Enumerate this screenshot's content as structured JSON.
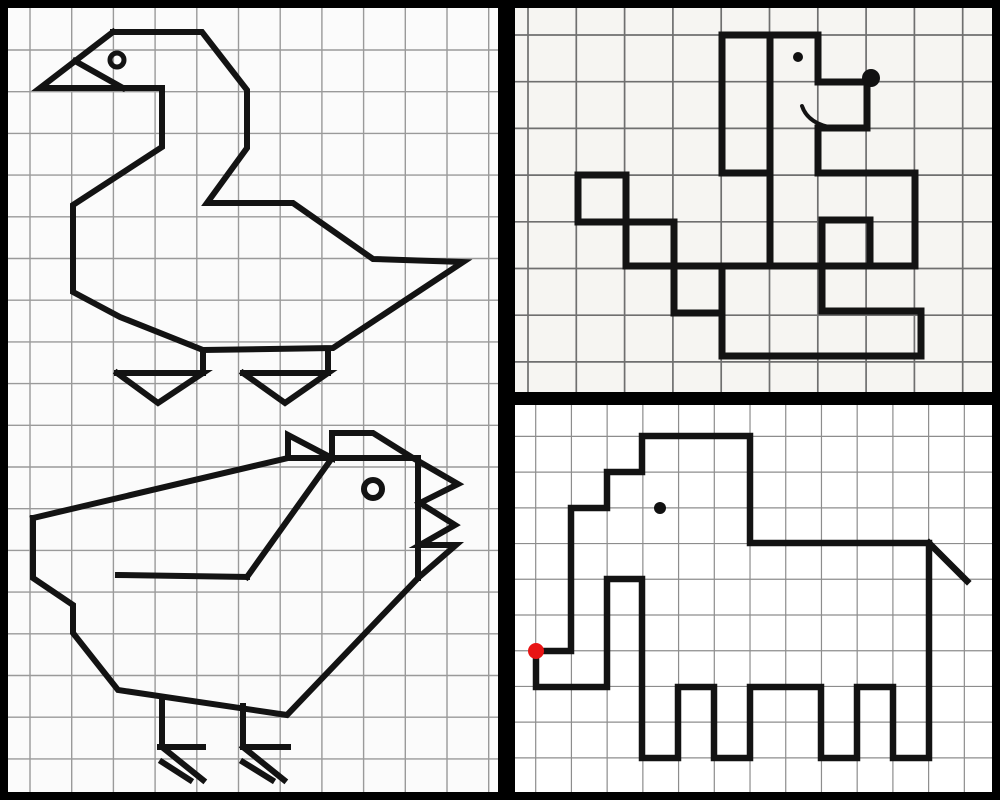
{
  "app": {
    "description": "Grid-drawing worksheet collage: goose and chicken on left, dog top-right, elephant bottom-right, drawn on squared paper inside a black frame"
  },
  "canvas": {
    "width": 1000,
    "height": 800,
    "frame_color": "#000000"
  },
  "panels": [
    {
      "name": "goose-chicken-panel",
      "x": 8,
      "y": 8,
      "width": 490,
      "height": 784,
      "bg": "#fbfbfb",
      "grid": {
        "color": "#9a9a9a",
        "width": 1.4,
        "x_start": 30,
        "y_start": 50,
        "cell_w": 41.7,
        "cell_h": 41.7,
        "x_count": 12,
        "y_count": 18
      },
      "figures": [
        "goose",
        "chicken"
      ]
    },
    {
      "name": "dog-panel",
      "x": 515,
      "y": 8,
      "width": 477,
      "height": 384,
      "bg": "#f6f5f2",
      "grid": {
        "color": "#6f6f6f",
        "width": 1.7,
        "x_start": 528,
        "y_start": 35,
        "cell_w": 48.3,
        "cell_h": 46.7,
        "x_count": 10,
        "y_count": 8
      },
      "figures": [
        "dog"
      ]
    },
    {
      "name": "elephant-panel",
      "x": 515,
      "y": 405,
      "width": 477,
      "height": 387,
      "bg": "#ffffff",
      "grid": {
        "color": "#8d8d8d",
        "width": 1.2,
        "x_start": 535.7,
        "y_start": 436.4,
        "cell_w": 35.72,
        "cell_h": 35.72,
        "x_count": 13,
        "y_count": 10
      },
      "figures": [
        "elephant"
      ]
    }
  ],
  "figures": {
    "goose": {
      "stroke": "#131313",
      "stroke_width": 6,
      "polylines": [
        [
          [
            113,
            32
          ],
          [
            202,
            32
          ],
          [
            247,
            90
          ],
          [
            247,
            148
          ],
          [
            207,
            203
          ],
          [
            293,
            203
          ],
          [
            373,
            259
          ],
          [
            463,
            262
          ],
          [
            333,
            348
          ],
          [
            203,
            350
          ],
          [
            120,
            317
          ],
          [
            73,
            292
          ],
          [
            73,
            205
          ],
          [
            162,
            147
          ],
          [
            162,
            88
          ],
          [
            40,
            88
          ],
          [
            113,
            32
          ]
        ],
        [
          [
            75,
            61
          ],
          [
            123,
            88
          ]
        ],
        [
          [
            203,
            350
          ],
          [
            203,
            373
          ]
        ],
        [
          [
            328,
            350
          ],
          [
            328,
            373
          ]
        ],
        [
          [
            117,
            373
          ],
          [
            203,
            373
          ],
          [
            158,
            403
          ],
          [
            117,
            373
          ]
        ],
        [
          [
            243,
            373
          ],
          [
            328,
            373
          ],
          [
            285,
            403
          ],
          [
            243,
            373
          ]
        ]
      ],
      "rings": [
        {
          "name": "goose-eye",
          "cx": 117,
          "cy": 60,
          "r": 7,
          "width": 5
        }
      ]
    },
    "chicken": {
      "stroke": "#131313",
      "stroke_width": 6,
      "polylines": [
        [
          [
            33,
            518
          ],
          [
            288,
            458
          ],
          [
            288,
            435
          ],
          [
            332,
            458
          ],
          [
            332,
            433
          ],
          [
            373,
            433
          ],
          [
            413,
            458
          ],
          [
            458,
            484
          ],
          [
            420,
            503
          ],
          [
            455,
            525
          ],
          [
            420,
            545
          ],
          [
            456,
            545
          ],
          [
            418,
            578
          ],
          [
            287,
            715
          ],
          [
            118,
            690
          ],
          [
            73,
            633
          ],
          [
            73,
            605
          ],
          [
            33,
            578
          ],
          [
            33,
            518
          ]
        ],
        [
          [
            288,
            458
          ],
          [
            418,
            458
          ]
        ],
        [
          [
            418,
            458
          ],
          [
            418,
            578
          ]
        ],
        [
          [
            332,
            458
          ],
          [
            247,
            577
          ]
        ],
        [
          [
            118,
            575
          ],
          [
            247,
            577
          ]
        ],
        [
          [
            162,
            698
          ],
          [
            162,
            747
          ]
        ],
        [
          [
            243,
            706
          ],
          [
            243,
            747
          ]
        ],
        [
          [
            160,
            747
          ],
          [
            203,
            747
          ]
        ],
        [
          [
            243,
            747
          ],
          [
            288,
            747
          ]
        ],
        [
          [
            162,
            747
          ],
          [
            203,
            780
          ]
        ],
        [
          [
            162,
            762
          ],
          [
            190,
            780
          ]
        ],
        [
          [
            243,
            747
          ],
          [
            284,
            780
          ]
        ],
        [
          [
            243,
            762
          ],
          [
            272,
            780
          ]
        ]
      ],
      "rings": [
        {
          "name": "chicken-eye",
          "cx": 373,
          "cy": 489,
          "r": 9,
          "width": 6
        }
      ]
    },
    "dog": {
      "stroke": "#131313",
      "stroke_width": 7,
      "segments": [
        [
          722,
          35,
          818,
          35
        ],
        [
          722,
          35,
          722,
          173
        ],
        [
          722,
          173,
          770,
          173
        ],
        [
          770,
          35,
          770,
          266
        ],
        [
          818,
          35,
          818,
          82
        ],
        [
          818,
          82,
          867,
          82
        ],
        [
          867,
          82,
          867,
          128
        ],
        [
          867,
          128,
          818,
          128
        ],
        [
          818,
          128,
          818,
          173
        ],
        [
          818,
          173,
          915,
          173
        ],
        [
          915,
          173,
          915,
          266
        ],
        [
          674,
          266,
          915,
          266
        ],
        [
          822,
          220,
          870,
          220
        ],
        [
          870,
          220,
          870,
          266
        ],
        [
          822,
          220,
          822,
          311
        ],
        [
          822,
          311,
          921,
          311
        ],
        [
          921,
          311,
          921,
          356
        ],
        [
          722,
          356,
          921,
          356
        ],
        [
          722,
          313,
          722,
          356
        ]
      ],
      "rects": [
        [
          578,
          175,
          48,
          47
        ],
        [
          626,
          222,
          48,
          44
        ],
        [
          674,
          266,
          48,
          47
        ]
      ],
      "dots": [
        {
          "name": "dog-eye",
          "cx": 798,
          "cy": 57,
          "r": 5,
          "fill": "#111111"
        },
        {
          "name": "dog-nose",
          "cx": 871,
          "cy": 78,
          "r": 9,
          "fill": "#111111"
        }
      ],
      "curves": [
        {
          "name": "dog-smile",
          "d": "M 802 106 Q 808 124 834 128",
          "width": 4
        }
      ]
    },
    "elephant": {
      "stroke": "#131313",
      "stroke_width": 6.5,
      "polylines": [
        [
          [
            642,
            436
          ],
          [
            750,
            436
          ],
          [
            750,
            543
          ],
          [
            929,
            543
          ],
          [
            929,
            758
          ],
          [
            893,
            758
          ],
          [
            893,
            687
          ],
          [
            857,
            687
          ],
          [
            857,
            758
          ],
          [
            821,
            758
          ],
          [
            821,
            687
          ],
          [
            750,
            687
          ],
          [
            750,
            758
          ],
          [
            714,
            758
          ],
          [
            714,
            687
          ],
          [
            678,
            687
          ],
          [
            678,
            758
          ],
          [
            642,
            758
          ],
          [
            642,
            579
          ],
          [
            607,
            579
          ],
          [
            607,
            687
          ],
          [
            536,
            687
          ],
          [
            536,
            651
          ],
          [
            571,
            651
          ],
          [
            571,
            508
          ],
          [
            607,
            508
          ],
          [
            607,
            472
          ],
          [
            642,
            472
          ],
          [
            642,
            436
          ]
        ],
        [
          [
            929,
            543
          ],
          [
            967,
            581
          ]
        ]
      ],
      "dots": [
        {
          "name": "elephant-eye",
          "cx": 660,
          "cy": 508,
          "r": 6,
          "fill": "#111111"
        },
        {
          "name": "elephant-start-dot",
          "cx": 536,
          "cy": 651,
          "r": 8,
          "fill": "#e81414"
        }
      ]
    }
  }
}
